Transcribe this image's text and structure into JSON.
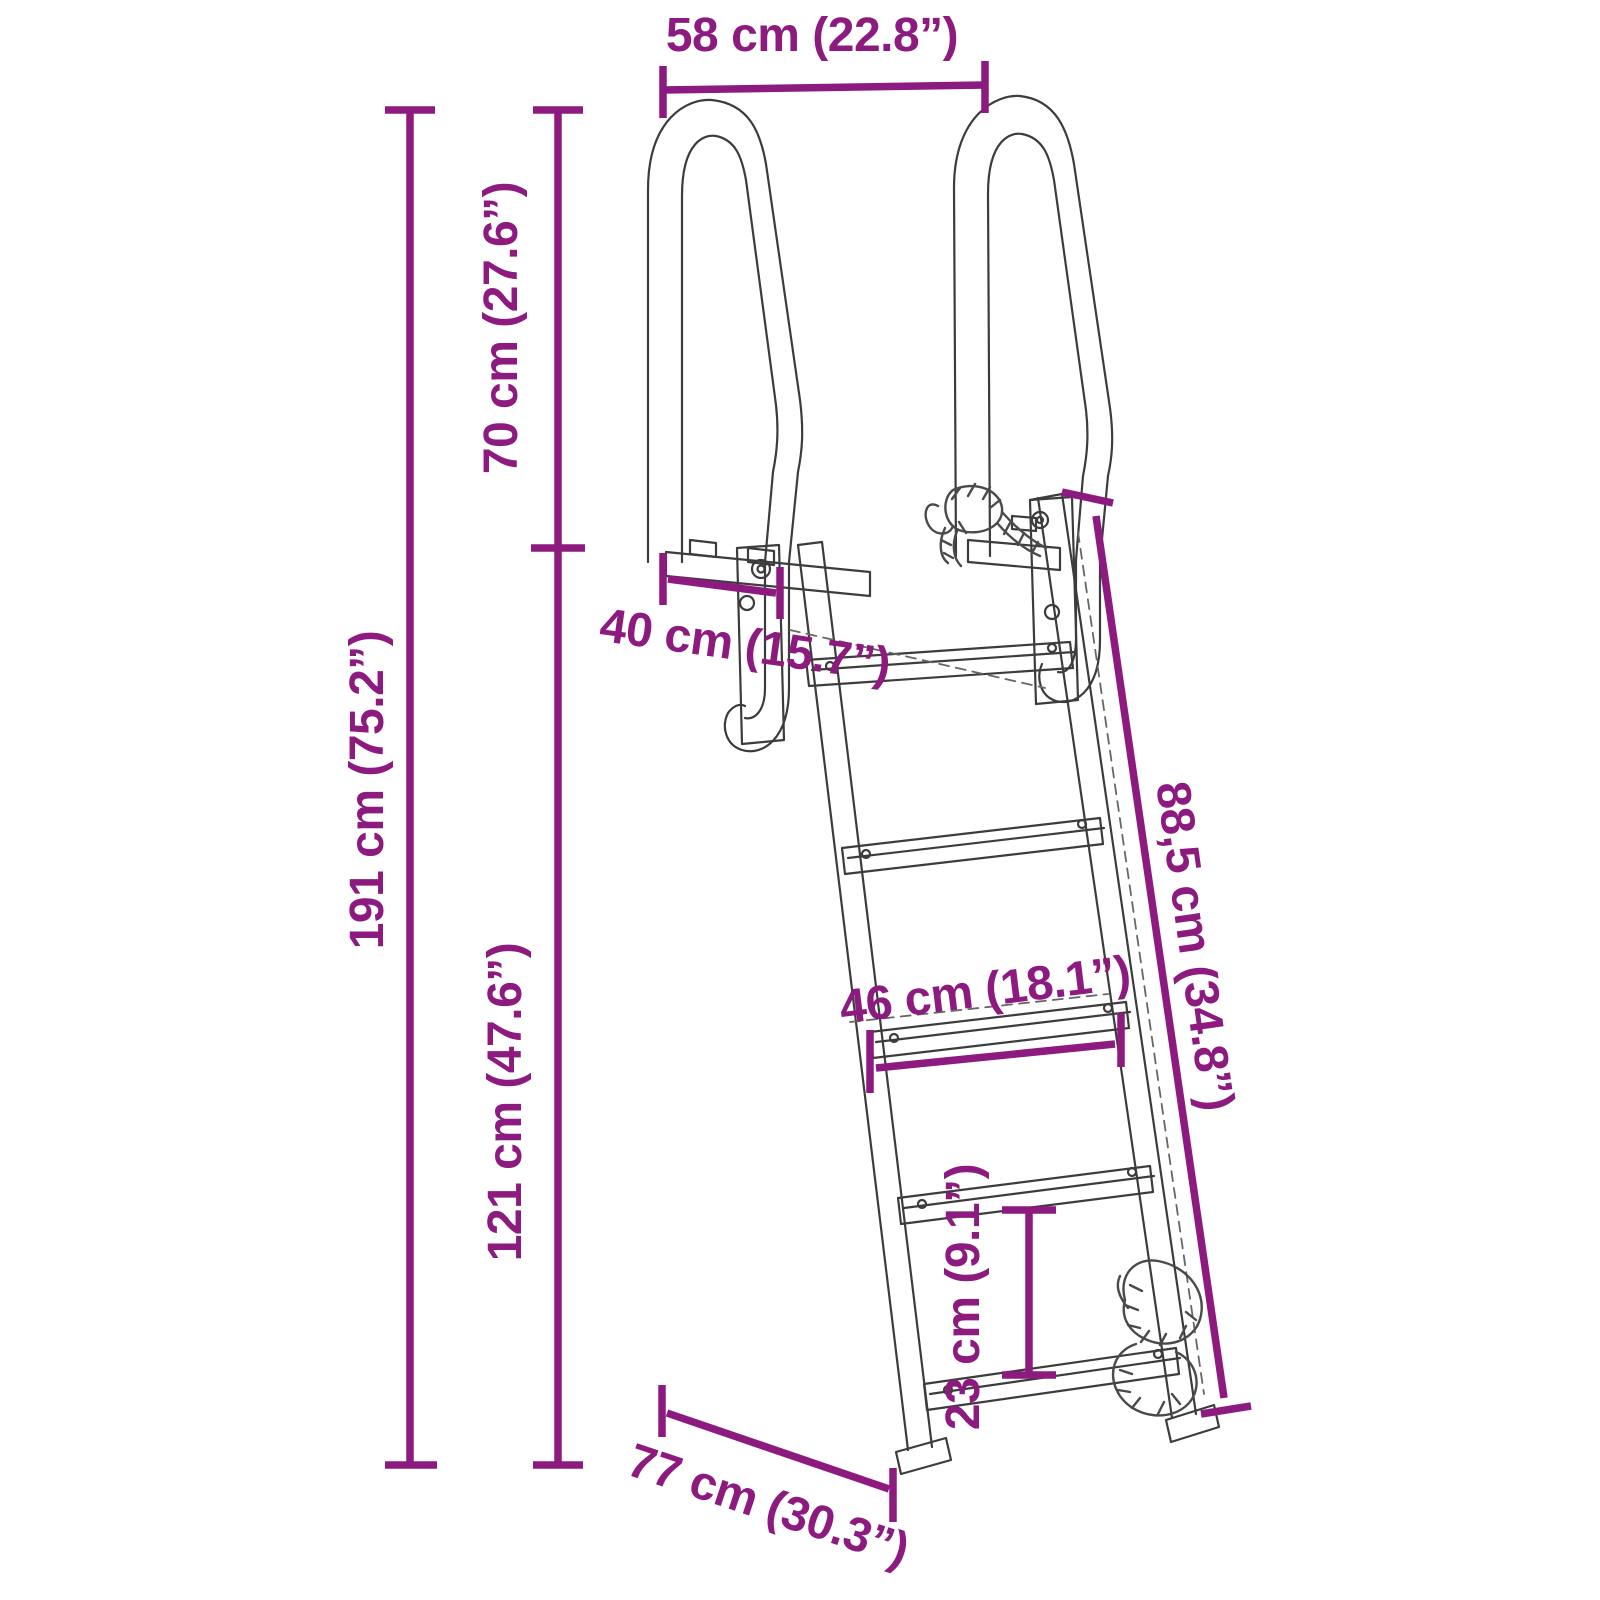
{
  "diagram": {
    "type": "product-dimension-diagram",
    "subject": "pool ladder with two handrails, five steps and safety rope",
    "background_color": "#ffffff",
    "accent_color": "#8C1A7F",
    "drawing_line_color": "#3C3C3C",
    "dimensions": {
      "top_width": "58 cm (22.8”)",
      "handrail_height": "70 cm (27.6”)",
      "total_height": "191 cm (75.2”)",
      "mount_depth": "40 cm (15.7”)",
      "rail_length": "88,5 cm (34.8”)",
      "step_width": "46 cm (18.1”)",
      "lower_height": "121 cm (47.6”)",
      "step_spacing": "23 cm (9.1”)",
      "base_depth": "77 cm (30.3”)"
    }
  }
}
